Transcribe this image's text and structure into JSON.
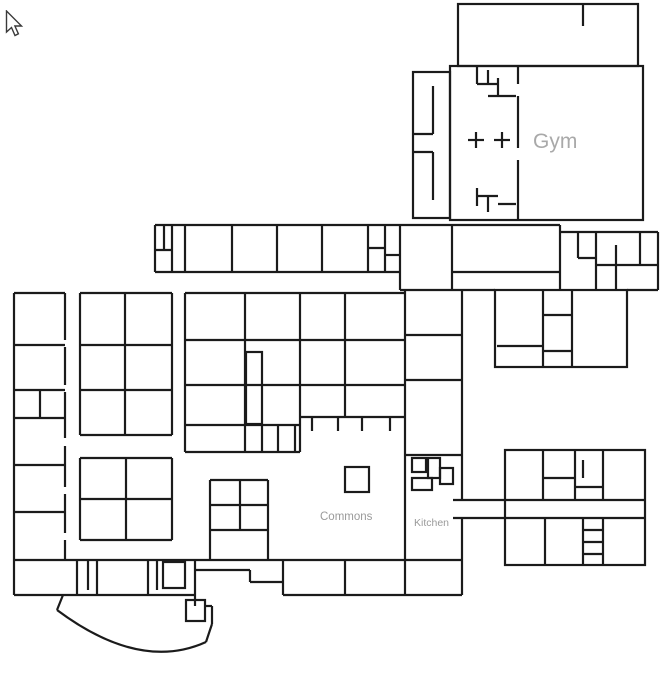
{
  "area_labels": {
    "gym": "Gym",
    "commons": "Commons",
    "kitchen": "Kitchen",
    "lobby": "Lobby"
  },
  "lobby_label_pos": {
    "x": 116,
    "y": 631
  },
  "top_tabs": [
    {
      "x": 9,
      "w": 28,
      "color": "#dcdcdc"
    },
    {
      "x": 56,
      "w": 28,
      "color": "#a0a0a0"
    },
    {
      "x": 99,
      "w": 29,
      "color": "#7a7a7a"
    },
    {
      "x": 143,
      "w": 30,
      "color": "#a8a8a8"
    }
  ],
  "colors": {
    "wall": "#1b1b1b",
    "room_label": "#a2a2a2",
    "clock_face": "#f1f0ee",
    "clock_ring": "#282828",
    "clock_detail": "#cccccc",
    "needle": "#c23a31",
    "needle_dark": "#8c2e26"
  },
  "rooms": [
    {
      "id": "509",
      "x": 189,
      "y": 240
    },
    {
      "id": "508",
      "x": 236,
      "y": 240
    },
    {
      "id": "507",
      "x": 281,
      "y": 240
    },
    {
      "id": "506",
      "x": 326,
      "y": 240
    },
    {
      "id": "504",
      "x": 403,
      "y": 240
    },
    {
      "id": "503",
      "x": 456,
      "y": 240
    },
    {
      "id": "502",
      "x": 501,
      "y": 302
    },
    {
      "id": "501",
      "x": 577,
      "y": 302
    },
    {
      "id": "605",
      "x": 17,
      "y": 343
    },
    {
      "id": "604",
      "x": 17,
      "y": 388
    },
    {
      "id": "603",
      "x": 17,
      "y": 462
    },
    {
      "id": "602",
      "x": 17,
      "y": 509
    },
    {
      "id": "601",
      "x": 17,
      "y": 556
    },
    {
      "id": "608",
      "x": 83,
      "y": 343
    },
    {
      "id": "607",
      "x": 83,
      "y": 388
    },
    {
      "id": "606",
      "x": 83,
      "y": 432
    },
    {
      "id": "706",
      "x": 153,
      "y": 343
    },
    {
      "id": "705",
      "x": 153,
      "y": 388
    },
    {
      "id": "704",
      "x": 153,
      "y": 432
    },
    {
      "id": "610",
      "x": 83,
      "y": 495
    },
    {
      "id": "612",
      "x": 151,
      "y": 495
    },
    {
      "id": "609",
      "x": 83,
      "y": 537
    },
    {
      "id": "611",
      "x": 151,
      "y": 537
    },
    {
      "id": "707",
      "x": 188,
      "y": 336
    },
    {
      "id": "708",
      "x": 188,
      "y": 381
    },
    {
      "id": "709",
      "x": 188,
      "y": 421
    },
    {
      "id": "111",
      "x": 188,
      "y": 449
    },
    {
      "id": "803",
      "x": 259,
      "y": 336
    },
    {
      "id": "802",
      "x": 259,
      "y": 381
    },
    {
      "id": "801",
      "x": 259,
      "y": 421
    },
    {
      "id": "804",
      "x": 303,
      "y": 336
    },
    {
      "id": "805",
      "x": 303,
      "y": 381
    },
    {
      "id": "806",
      "x": 303,
      "y": 413
    },
    {
      "id": "903",
      "x": 359,
      "y": 336
    },
    {
      "id": "902",
      "x": 359,
      "y": 381
    },
    {
      "id": "901",
      "x": 359,
      "y": 413
    },
    {
      "id": "904",
      "x": 409,
      "y": 331
    },
    {
      "id": "905",
      "x": 409,
      "y": 376
    },
    {
      "id": "906",
      "x": 411,
      "y": 447
    },
    {
      "id": "301",
      "x": 521,
      "y": 463
    },
    {
      "id": "303",
      "x": 611,
      "y": 463
    },
    {
      "id": "307",
      "x": 510,
      "y": 561
    },
    {
      "id": "305",
      "x": 566,
      "y": 561
    },
    {
      "id": "304",
      "x": 619,
      "y": 561
    },
    {
      "id": "406",
      "x": 55,
      "y": 592
    },
    {
      "id": "405",
      "x": 108,
      "y": 592
    },
    {
      "id": "403",
      "x": 321,
      "y": 592
    },
    {
      "id": "402",
      "x": 382,
      "y": 592
    },
    {
      "id": "401",
      "x": 442,
      "y": 592
    }
  ],
  "tiny_labels": [
    {
      "t": "114",
      "x": 269,
      "y": 441
    },
    {
      "t": "118",
      "x": 286,
      "y": 441
    }
  ],
  "clocks": [
    [
      78,
      111
    ],
    [
      152,
      108
    ],
    [
      583,
      43
    ],
    [
      576,
      218
    ],
    [
      213,
      252
    ],
    [
      258,
      252
    ],
    [
      301,
      252
    ],
    [
      344,
      252
    ],
    [
      427,
      252
    ],
    [
      500,
      270
    ],
    [
      39,
      318
    ],
    [
      39,
      372
    ],
    [
      40,
      443
    ],
    [
      38,
      492
    ],
    [
      37,
      532
    ],
    [
      102,
      320
    ],
    [
      102,
      365
    ],
    [
      102,
      410
    ],
    [
      148,
      320
    ],
    [
      148,
      365
    ],
    [
      148,
      410
    ],
    [
      126,
      433
    ],
    [
      103,
      480
    ],
    [
      146,
      482
    ],
    [
      99,
      518
    ],
    [
      149,
      518
    ],
    [
      210,
      310
    ],
    [
      212,
      353
    ],
    [
      210,
      397
    ],
    [
      258,
      310
    ],
    [
      260,
      357
    ],
    [
      262,
      400
    ],
    [
      235,
      437
    ],
    [
      323,
      308
    ],
    [
      323,
      353
    ],
    [
      323,
      395
    ],
    [
      368,
      308
    ],
    [
      367,
      353
    ],
    [
      368,
      395
    ],
    [
      432,
      310
    ],
    [
      433,
      353
    ],
    [
      432,
      408
    ],
    [
      520,
      321
    ],
    [
      599,
      333
    ],
    [
      396,
      492
    ],
    [
      524,
      473
    ],
    [
      625,
      473
    ],
    [
      548,
      541
    ],
    [
      625,
      542
    ],
    [
      243,
      497
    ],
    [
      237,
      547
    ],
    [
      137,
      629
    ],
    [
      47,
      580
    ],
    [
      125,
      580
    ],
    [
      313,
      580
    ],
    [
      375,
      580
    ],
    [
      433,
      580
    ]
  ],
  "walls": {
    "rects": [
      [
        458,
        4,
        180,
        62
      ],
      [
        450,
        66,
        193,
        154
      ],
      [
        413,
        72,
        37,
        146
      ],
      [
        495,
        290,
        132,
        77
      ],
      [
        505,
        450,
        140,
        115
      ],
      [
        246,
        352,
        16,
        72
      ],
      [
        345,
        467,
        24,
        25
      ],
      [
        186,
        600,
        19,
        21
      ],
      [
        412,
        458,
        14,
        14
      ],
      [
        428,
        458,
        12,
        20
      ],
      [
        412,
        478,
        20,
        12
      ],
      [
        440,
        468,
        13,
        16
      ],
      [
        163,
        562,
        22,
        26
      ]
    ],
    "lines": [
      [
        583,
        4,
        583,
        26
      ],
      [
        518,
        66,
        518,
        84
      ],
      [
        518,
        96,
        518,
        148
      ],
      [
        518,
        160,
        518,
        220
      ],
      [
        477,
        66,
        477,
        84
      ],
      [
        477,
        84,
        498,
        84
      ],
      [
        488,
        70,
        488,
        84
      ],
      [
        498,
        78,
        498,
        96
      ],
      [
        488,
        96,
        516,
        96
      ],
      [
        468,
        140,
        484,
        140
      ],
      [
        476,
        132,
        476,
        148
      ],
      [
        494,
        140,
        510,
        140
      ],
      [
        502,
        132,
        502,
        148
      ],
      [
        477,
        188,
        477,
        206
      ],
      [
        477,
        196,
        498,
        196
      ],
      [
        488,
        196,
        488,
        212
      ],
      [
        498,
        204,
        516,
        204
      ],
      [
        433,
        86,
        433,
        134
      ],
      [
        413,
        134,
        433,
        134
      ],
      [
        433,
        152,
        433,
        200
      ],
      [
        413,
        152,
        433,
        152
      ],
      [
        155,
        225,
        560,
        225
      ],
      [
        155,
        225,
        155,
        272
      ],
      [
        164,
        225,
        164,
        250
      ],
      [
        172,
        225,
        172,
        272
      ],
      [
        155,
        250,
        172,
        250
      ],
      [
        185,
        225,
        185,
        272
      ],
      [
        232,
        225,
        232,
        272
      ],
      [
        277,
        225,
        277,
        272
      ],
      [
        322,
        225,
        322,
        272
      ],
      [
        368,
        225,
        368,
        272
      ],
      [
        155,
        272,
        368,
        272
      ],
      [
        368,
        248,
        385,
        248
      ],
      [
        385,
        225,
        385,
        272
      ],
      [
        385,
        255,
        400,
        255
      ],
      [
        368,
        272,
        400,
        272
      ],
      [
        400,
        225,
        400,
        290
      ],
      [
        452,
        225,
        452,
        290
      ],
      [
        400,
        290,
        462,
        290
      ],
      [
        452,
        272,
        560,
        272
      ],
      [
        560,
        225,
        560,
        290
      ],
      [
        560,
        232,
        658,
        232
      ],
      [
        658,
        232,
        658,
        290
      ],
      [
        578,
        232,
        578,
        258
      ],
      [
        578,
        258,
        596,
        258
      ],
      [
        596,
        232,
        596,
        290
      ],
      [
        596,
        265,
        616,
        265
      ],
      [
        616,
        245,
        616,
        290
      ],
      [
        640,
        232,
        640,
        265
      ],
      [
        616,
        265,
        658,
        265
      ],
      [
        627,
        290,
        658,
        290
      ],
      [
        462,
        290,
        495,
        290
      ],
      [
        14,
        293,
        65,
        293
      ],
      [
        80,
        293,
        172,
        293
      ],
      [
        185,
        293,
        405,
        293
      ],
      [
        14,
        293,
        14,
        560
      ],
      [
        65,
        293,
        65,
        340
      ],
      [
        65,
        347,
        65,
        385
      ],
      [
        65,
        392,
        65,
        438
      ],
      [
        65,
        446,
        65,
        487
      ],
      [
        65,
        494,
        65,
        533
      ],
      [
        65,
        540,
        65,
        560
      ],
      [
        14,
        345,
        65,
        345
      ],
      [
        14,
        390,
        65,
        390
      ],
      [
        14,
        418,
        65,
        418
      ],
      [
        40,
        390,
        40,
        418
      ],
      [
        14,
        465,
        65,
        465
      ],
      [
        14,
        512,
        65,
        512
      ],
      [
        80,
        293,
        80,
        435
      ],
      [
        125,
        293,
        125,
        435
      ],
      [
        172,
        293,
        172,
        435
      ],
      [
        80,
        345,
        172,
        345
      ],
      [
        80,
        390,
        172,
        390
      ],
      [
        80,
        435,
        172,
        435
      ],
      [
        80,
        458,
        80,
        540
      ],
      [
        126,
        458,
        126,
        540
      ],
      [
        172,
        458,
        172,
        540
      ],
      [
        80,
        458,
        172,
        458
      ],
      [
        80,
        499,
        172,
        499
      ],
      [
        80,
        540,
        172,
        540
      ],
      [
        185,
        293,
        185,
        452
      ],
      [
        245,
        293,
        245,
        452
      ],
      [
        300,
        293,
        300,
        452
      ],
      [
        185,
        340,
        300,
        340
      ],
      [
        185,
        385,
        300,
        385
      ],
      [
        185,
        425,
        300,
        425
      ],
      [
        185,
        452,
        300,
        452
      ],
      [
        262,
        425,
        262,
        452
      ],
      [
        278,
        425,
        278,
        452
      ],
      [
        295,
        425,
        295,
        452
      ],
      [
        345,
        293,
        345,
        417
      ],
      [
        300,
        340,
        405,
        340
      ],
      [
        300,
        385,
        405,
        385
      ],
      [
        300,
        417,
        405,
        417
      ],
      [
        312,
        417,
        312,
        431
      ],
      [
        338,
        417,
        338,
        431
      ],
      [
        362,
        417,
        362,
        431
      ],
      [
        390,
        417,
        390,
        431
      ],
      [
        405,
        290,
        405,
        455
      ],
      [
        462,
        290,
        462,
        500
      ],
      [
        462,
        518,
        462,
        560
      ],
      [
        405,
        335,
        462,
        335
      ],
      [
        405,
        380,
        462,
        380
      ],
      [
        405,
        455,
        462,
        455
      ],
      [
        405,
        455,
        405,
        560
      ],
      [
        453,
        500,
        505,
        500
      ],
      [
        453,
        518,
        505,
        518
      ],
      [
        543,
        290,
        543,
        367
      ],
      [
        572,
        290,
        572,
        367
      ],
      [
        543,
        315,
        572,
        315
      ],
      [
        497,
        346,
        543,
        346
      ],
      [
        543,
        351,
        572,
        351
      ],
      [
        543,
        450,
        543,
        500
      ],
      [
        575,
        450,
        575,
        500
      ],
      [
        603,
        450,
        603,
        500
      ],
      [
        543,
        478,
        575,
        478
      ],
      [
        575,
        487,
        603,
        487
      ],
      [
        583,
        460,
        583,
        478
      ],
      [
        505,
        500,
        645,
        500
      ],
      [
        505,
        518,
        645,
        518
      ],
      [
        545,
        518,
        545,
        565
      ],
      [
        583,
        518,
        583,
        565
      ],
      [
        603,
        518,
        603,
        565
      ],
      [
        583,
        530,
        603,
        530
      ],
      [
        583,
        542,
        603,
        542
      ],
      [
        583,
        554,
        603,
        554
      ],
      [
        210,
        480,
        268,
        480
      ],
      [
        210,
        480,
        210,
        560
      ],
      [
        240,
        480,
        240,
        530
      ],
      [
        268,
        480,
        268,
        530
      ],
      [
        210,
        505,
        268,
        505
      ],
      [
        210,
        530,
        268,
        530
      ],
      [
        268,
        530,
        268,
        560
      ],
      [
        14,
        560,
        462,
        560
      ],
      [
        14,
        560,
        14,
        595
      ],
      [
        77,
        560,
        77,
        595
      ],
      [
        88,
        560,
        88,
        590
      ],
      [
        97,
        560,
        97,
        595
      ],
      [
        148,
        560,
        148,
        595
      ],
      [
        157,
        560,
        157,
        590
      ],
      [
        195,
        560,
        195,
        595
      ],
      [
        14,
        595,
        195,
        595
      ],
      [
        195,
        570,
        250,
        570
      ],
      [
        250,
        570,
        250,
        582
      ],
      [
        250,
        582,
        283,
        582
      ],
      [
        283,
        560,
        283,
        595
      ],
      [
        345,
        560,
        345,
        595
      ],
      [
        405,
        560,
        405,
        595
      ],
      [
        462,
        560,
        462,
        595
      ],
      [
        283,
        595,
        462,
        595
      ],
      [
        63,
        595,
        57,
        610
      ],
      [
        206,
        642,
        212,
        624
      ],
      [
        212,
        624,
        212,
        606
      ],
      [
        205,
        606,
        212,
        606
      ],
      [
        195,
        595,
        195,
        606
      ]
    ],
    "paths": [
      "M57,610 Q140,672 206,642"
    ]
  }
}
